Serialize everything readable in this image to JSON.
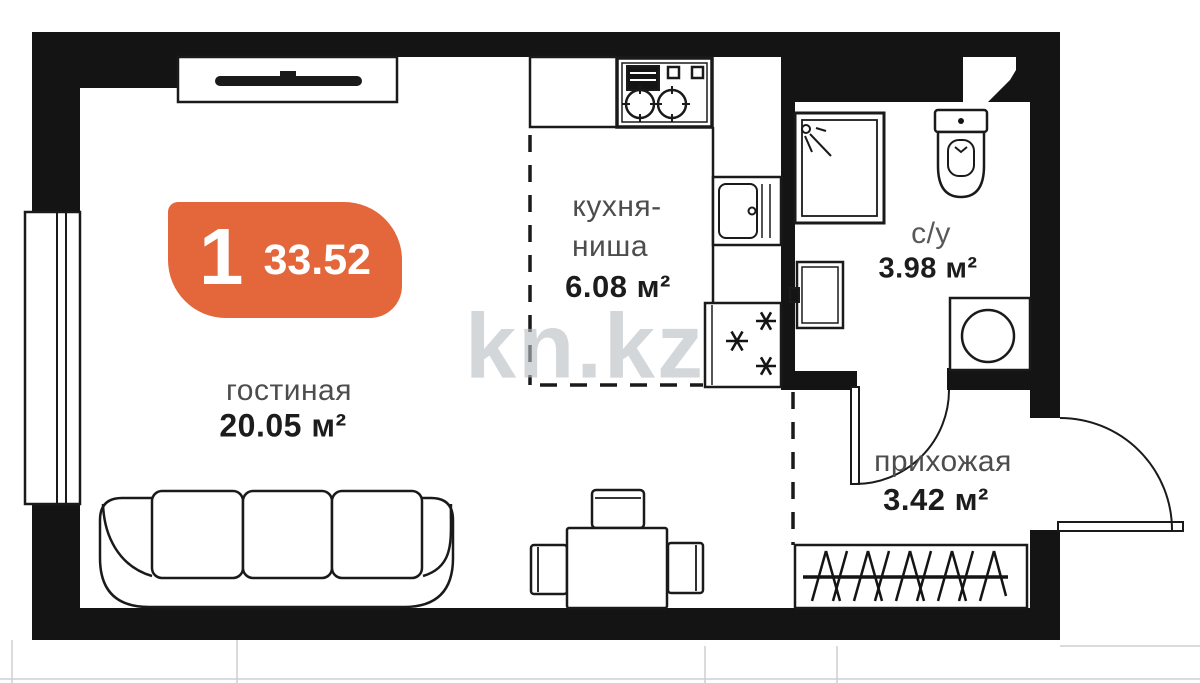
{
  "floorplan": {
    "badge": {
      "number": "1",
      "total_area": "33.52",
      "color": "#e4663b"
    },
    "watermark": "kn.kz",
    "rooms": {
      "living": {
        "name": "гостиная",
        "area": "20.05 м²"
      },
      "kitchen": {
        "name_line1": "кухня-",
        "name_line2": "ниша",
        "area": "6.08 м²"
      },
      "bathroom": {
        "name": "с/у",
        "area": "3.98 м²"
      },
      "hallway": {
        "name": "прихожая",
        "area": "3.42 м²"
      }
    },
    "colors": {
      "walls": "#141414",
      "lines": "#1a1a1a",
      "badge": "#e4663b",
      "watermark_gray": "#b9bec1"
    }
  }
}
